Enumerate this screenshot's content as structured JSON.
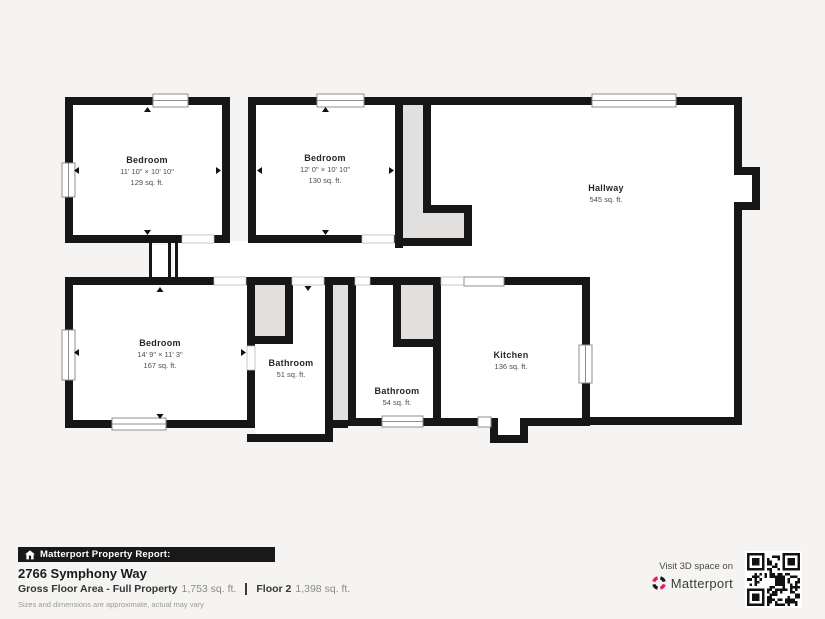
{
  "rooms": [
    {
      "name": "Bedroom",
      "dims": "11' 10\" × 10' 10\"",
      "area": "129 sq. ft."
    },
    {
      "name": "Bedroom",
      "dims": "12' 0\" × 10' 10\"",
      "area": "130 sq. ft."
    },
    {
      "name": "Hallway",
      "dims": "",
      "area": "545 sq. ft."
    },
    {
      "name": "Bedroom",
      "dims": "14' 9\" × 11' 3\"",
      "area": "167 sq. ft."
    },
    {
      "name": "Bathroom",
      "dims": "",
      "area": "51 sq. ft."
    },
    {
      "name": "Bathroom",
      "dims": "",
      "area": "54 sq. ft."
    },
    {
      "name": "Kitchen",
      "dims": "",
      "area": "136 sq. ft."
    }
  ],
  "footer": {
    "banner": "Matterport Property Report:",
    "address": "2766 Symphony Way",
    "gross_label": "Gross Floor Area - Full Property",
    "gross_value": "1,753 sq. ft.",
    "floor_label": "Floor 2",
    "floor_value": "1,398 sq. ft.",
    "disclaimer": "Sizes and dimensions are approximate, actual may vary",
    "visit_text": "Visit 3D space on",
    "brand": "Matterport"
  },
  "colors": {
    "background": "#f5f4f2",
    "wall": "#161616",
    "room_fill": "#ffffff",
    "feature_gray": "#e1e0de",
    "banner_bg": "#191919",
    "brand_red": "#e31c5f"
  }
}
